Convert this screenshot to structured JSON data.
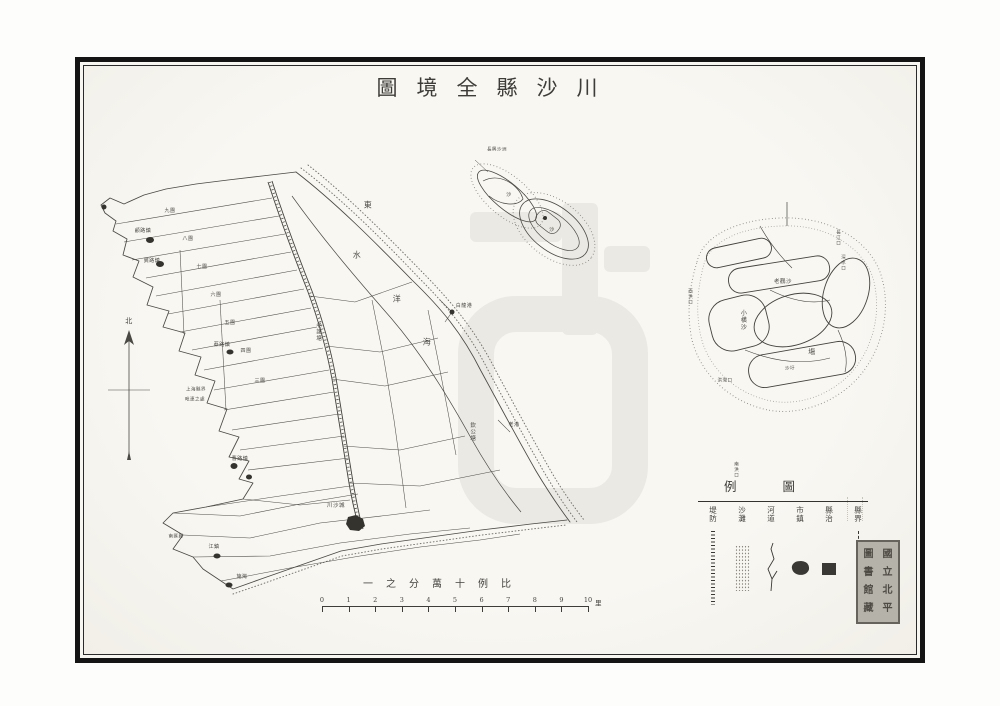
{
  "title": {
    "text_rtl": "川沙縣全境圖",
    "display_chars": [
      "圖",
      "境",
      "全",
      "縣",
      "沙",
      "川"
    ]
  },
  "scale": {
    "text_rtl": "比例十萬分之一",
    "display_chars": [
      "一",
      "之",
      "分",
      "萬",
      "十",
      "例",
      "比"
    ],
    "ticks": [
      "0",
      "1",
      "2",
      "3",
      "4",
      "5",
      "6",
      "7",
      "8",
      "9",
      "10"
    ],
    "unit": "里"
  },
  "legend": {
    "title_rtl": "圖例",
    "title_display_chars": [
      "例",
      "圖"
    ],
    "items": [
      {
        "label": "縣界",
        "symbol": "boundary-dashed-line"
      },
      {
        "label": "縣治",
        "symbol": "filled-square"
      },
      {
        "label": "市鎮",
        "symbol": "town-blob"
      },
      {
        "label": "河道",
        "symbol": "river-line"
      },
      {
        "label": "沙灘",
        "symbol": "sand-stipple"
      },
      {
        "label": "堤防",
        "symbol": "dike-hatched-line"
      }
    ]
  },
  "seal": {
    "columns": [
      [
        "國",
        "立",
        "北",
        "平"
      ],
      [
        "圖",
        "書",
        "館",
        "藏"
      ]
    ]
  },
  "map_labels": [
    {
      "t": "北",
      "x": 129,
      "y": 322,
      "v": 0,
      "fs": 7
    },
    {
      "t": "東",
      "x": 368,
      "y": 206,
      "v": 0,
      "fs": 8
    },
    {
      "t": "水",
      "x": 357,
      "y": 256,
      "v": 0,
      "fs": 8
    },
    {
      "t": "洋",
      "x": 397,
      "y": 300,
      "v": 0,
      "fs": 8
    },
    {
      "t": "海",
      "x": 427,
      "y": 343,
      "v": 0,
      "fs": 8
    },
    {
      "t": "老護塘",
      "x": 318,
      "y": 332,
      "v": 1,
      "fs": 5.5
    },
    {
      "t": "欽公塘",
      "x": 472,
      "y": 432,
      "v": 1,
      "fs": 5.5
    },
    {
      "t": "九團",
      "x": 170,
      "y": 212,
      "v": 0,
      "fs": 5
    },
    {
      "t": "八團",
      "x": 188,
      "y": 240,
      "v": 0,
      "fs": 5
    },
    {
      "t": "七團",
      "x": 202,
      "y": 268,
      "v": 0,
      "fs": 5
    },
    {
      "t": "六團",
      "x": 216,
      "y": 296,
      "v": 0,
      "fs": 5
    },
    {
      "t": "五團",
      "x": 230,
      "y": 324,
      "v": 0,
      "fs": 5
    },
    {
      "t": "四團",
      "x": 246,
      "y": 352,
      "v": 0,
      "fs": 5
    },
    {
      "t": "三團",
      "x": 260,
      "y": 382,
      "v": 0,
      "fs": 5
    },
    {
      "t": "顧路鎮",
      "x": 143,
      "y": 232,
      "v": 0,
      "fs": 5
    },
    {
      "t": "龔路鎮",
      "x": 152,
      "y": 262,
      "v": 0,
      "fs": 5
    },
    {
      "t": "蔡路鎮",
      "x": 222,
      "y": 346,
      "v": 0,
      "fs": 5
    },
    {
      "t": "曹路鎮",
      "x": 240,
      "y": 460,
      "v": 0,
      "fs": 5
    },
    {
      "t": "白龍港",
      "x": 464,
      "y": 307,
      "v": 0,
      "fs": 5
    },
    {
      "t": "老港",
      "x": 514,
      "y": 426,
      "v": 0,
      "fs": 5
    },
    {
      "t": "川沙城",
      "x": 336,
      "y": 506,
      "v": 0,
      "fs": 5.5
    },
    {
      "t": "江鎮",
      "x": 214,
      "y": 548,
      "v": 0,
      "fs": 5
    },
    {
      "t": "施灣",
      "x": 242,
      "y": 578,
      "v": 0,
      "fs": 5
    },
    {
      "t": "上海縣界",
      "x": 196,
      "y": 390,
      "v": 0,
      "fs": 4.5
    },
    {
      "t": "毗連之處",
      "x": 195,
      "y": 400,
      "v": 0,
      "fs": 4.5
    },
    {
      "t": "南匯縣",
      "x": 176,
      "y": 537,
      "v": 0,
      "fs": 4.5
    },
    {
      "t": "長興沙洲",
      "x": 497,
      "y": 150,
      "v": 0,
      "fs": 4.5
    },
    {
      "t": "沙",
      "x": 509,
      "y": 196,
      "v": 0,
      "fs": 5
    },
    {
      "t": "沙",
      "x": 552,
      "y": 231,
      "v": 0,
      "fs": 5
    },
    {
      "t": "老鸛沙",
      "x": 783,
      "y": 282,
      "v": 0,
      "fs": 5.5
    },
    {
      "t": "小橫沙",
      "x": 742,
      "y": 320,
      "v": 1,
      "fs": 6
    },
    {
      "t": "塲",
      "x": 812,
      "y": 353,
      "v": 0,
      "fs": 7
    },
    {
      "t": "沙圩",
      "x": 790,
      "y": 369,
      "v": 0,
      "fs": 4.5
    },
    {
      "t": "長江口",
      "x": 838,
      "y": 238,
      "v": 1,
      "fs": 4.5
    },
    {
      "t": "深水口",
      "x": 843,
      "y": 263,
      "v": 1,
      "fs": 4.5
    },
    {
      "t": "西洪口",
      "x": 690,
      "y": 297,
      "v": 1,
      "fs": 4.5
    },
    {
      "t": "洪灣口",
      "x": 725,
      "y": 381,
      "v": 0,
      "fs": 4.5
    },
    {
      "t": "南洪口",
      "x": 736,
      "y": 470,
      "v": 1,
      "fs": 4.5
    }
  ],
  "colors": {
    "paper": "#f7f6f1",
    "ink": "#4a4842",
    "frame": "#141414",
    "watermark": "#ebe9e3",
    "seal_bg": "#b5b2aa"
  }
}
